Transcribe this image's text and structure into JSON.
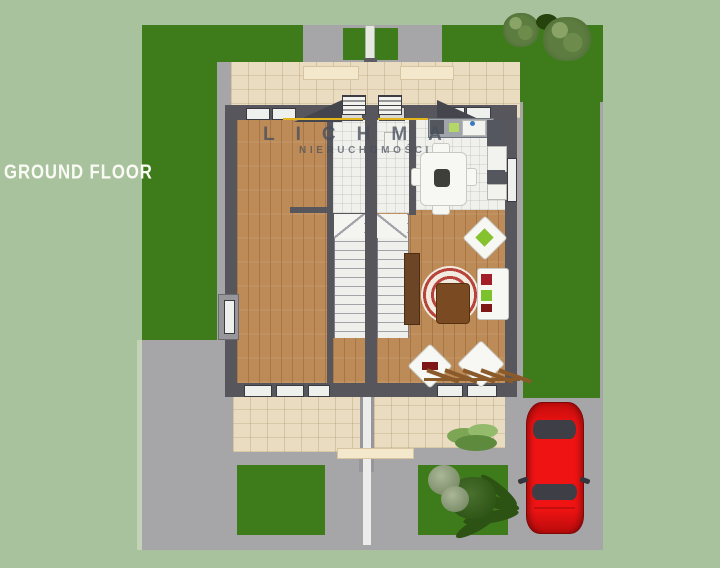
{
  "labels": {
    "floor_label": "GROUND FLOOR"
  },
  "watermark": {
    "brand": "LICHMA",
    "subtitle": "NIERUCHOMOŚCI"
  },
  "colors": {
    "background": "#a9c29e",
    "grass": "#3e7c1b",
    "road": "#a6a6a9",
    "pavers": "#e9dcc0",
    "wood_floor": "#bd8b57",
    "tile_floor": "#f0f0ed",
    "walls": "#56565c",
    "car_red": "#e31010",
    "gutter_accent": "#e2b61c",
    "rug_red": "#b8453c"
  },
  "elements": [
    "semi-detached-house-plan",
    "left-unit-room",
    "right-unit-living-room",
    "kitchen-with-sink-and-cooktop",
    "dining-table-with-chairs",
    "two-staircases-at-party-wall",
    "sofa",
    "armchairs",
    "spiral-area-rug",
    "coffee-table",
    "tv-cabinet",
    "terrace-with-pergola",
    "dividing-fence",
    "front-entry-steps",
    "lawns",
    "trees-and-shrubs",
    "red-car-on-driveway"
  ]
}
